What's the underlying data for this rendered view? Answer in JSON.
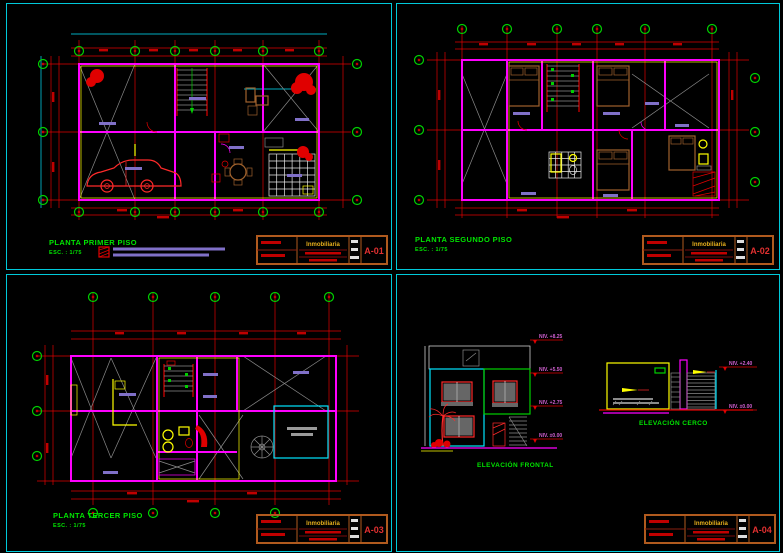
{
  "palette": {
    "background": "#000000",
    "panel_border_cyan": "#00c9da",
    "grid_red": "#e00000",
    "wall_magenta": "#ff00ff",
    "title_green": "#00e400",
    "axis_bubble_green": "#00d000",
    "furniture_brown": "#a0622d",
    "fixture_yellow": "#ffff00",
    "label_purple": "#8070c8",
    "titleblock_orange": "#b05a1e",
    "sheet_red": "#e03030"
  },
  "panels": [
    {
      "title": "PLANTA PRIMER PISO",
      "scale": "ESC. : 1/75",
      "sheet": "A-01"
    },
    {
      "title": "PLANTA SEGUNDO PISO",
      "scale": "ESC. : 1/75",
      "sheet": "A-02"
    },
    {
      "title": "PLANTA TERCER PISO",
      "scale": "ESC. : 1/75",
      "sheet": "A-03"
    },
    {
      "sheet": "A-04",
      "frontal": {
        "label": "ELEVACIÓN FRONTAL",
        "levels": [
          "NIV. +8.25",
          "NIV. +5.50",
          "NIV. +2.75",
          "NIV. ±0.00"
        ]
      },
      "cerco": {
        "label": "ELEVACIÓN CERCO",
        "level_top": "NIV. +2.40",
        "level_base": "NIV. ±0.00"
      }
    }
  ],
  "titleblock": {
    "company": "Inmobiliaria"
  }
}
